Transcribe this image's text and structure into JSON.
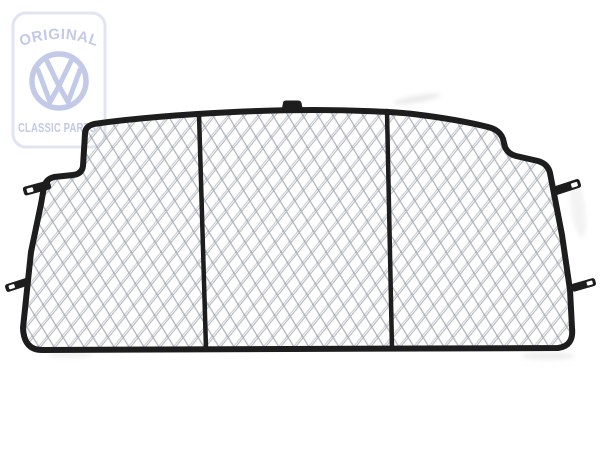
{
  "page": {
    "background_color": "#ffffff"
  },
  "watermark": {
    "top_text": "ORIGINAL",
    "bottom_text": "CLASSIC PARTS",
    "logo_name": "vw-roundel-logo",
    "text_color": "#c3cae8",
    "border_color": "#e0e4f3"
  },
  "product": {
    "frame_color": "#1d1d1d",
    "mesh_line_color": "#c9cdd4",
    "mesh_shadow_color": "#aeb3bb",
    "panel_count": 3,
    "left_mounting_tab_count": 2,
    "right_mounting_tab_count": 2,
    "top_tab_count": 1
  }
}
